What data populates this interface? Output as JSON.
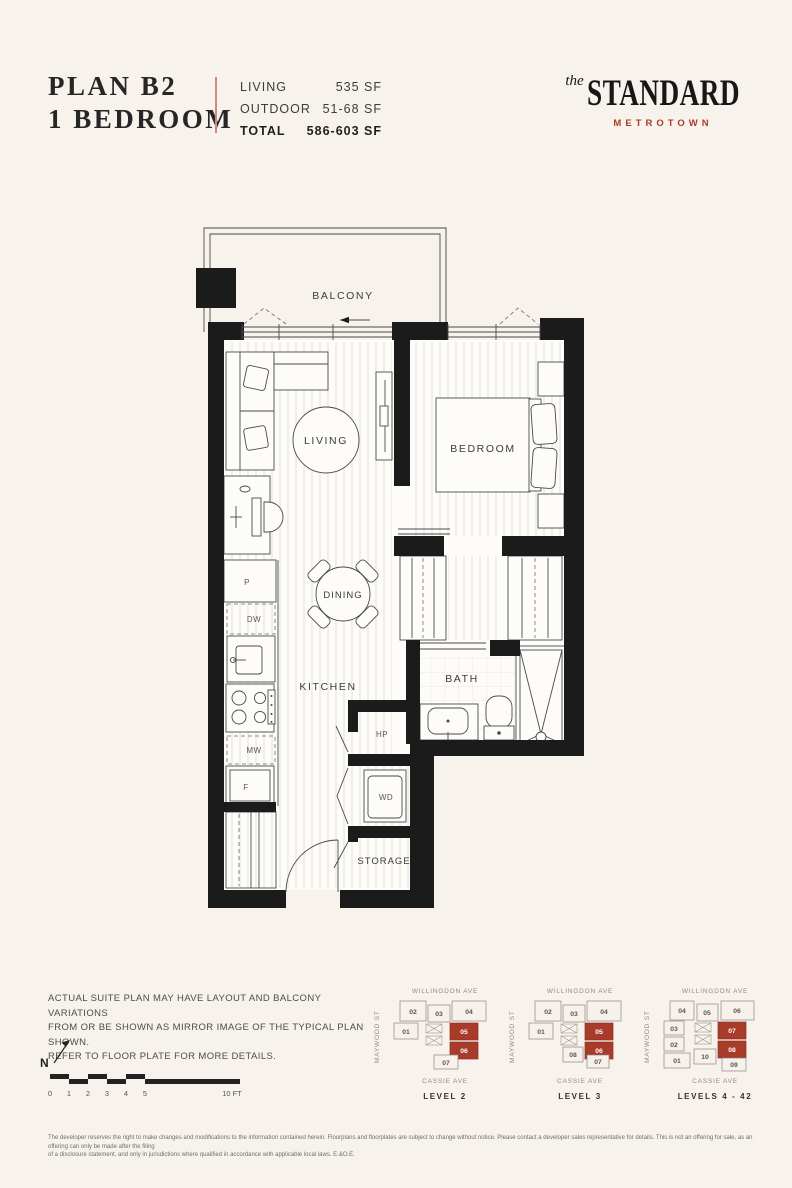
{
  "header": {
    "plan_name_line1": "PLAN B2",
    "plan_name_line2": "1 BEDROOM",
    "stats": [
      {
        "label": "LIVING",
        "value": "535 SF"
      },
      {
        "label": "OUTDOOR",
        "value": "51-68 SF"
      },
      {
        "label": "TOTAL",
        "value": "586-603 SF"
      }
    ]
  },
  "logo": {
    "prefix": "the",
    "name": "STANDARD",
    "sub": "METROTOWN",
    "accent_color": "#ad3a2a"
  },
  "floorplan": {
    "rooms": {
      "balcony": "BALCONY",
      "living": "LIVING",
      "bedroom": "BEDROOM",
      "dining": "DINING",
      "kitchen": "KITCHEN",
      "bath": "BATH",
      "storage": "STORAGE"
    },
    "appliances": {
      "pantry": "P",
      "dishwasher": "DW",
      "microwave": "MW",
      "fridge": "F",
      "heat_pump": "HP",
      "washer_dryer": "WD"
    }
  },
  "notes": {
    "line1": "ACTUAL SUITE PLAN MAY HAVE LAYOUT AND BALCONY VARIATIONS",
    "line2": "FROM OR BE SHOWN AS MIRROR IMAGE OF THE TYPICAL PLAN SHOWN.",
    "line3": "REFER TO FLOOR PLATE FOR MORE DETAILS."
  },
  "compass": {
    "label": "N"
  },
  "scale_bar": {
    "ticks": [
      "0",
      "1",
      "2",
      "3",
      "4",
      "5"
    ],
    "end_label": "10 FT"
  },
  "keyplans": [
    {
      "street_top": "WILLINGDON AVE",
      "street_left": "MAYWOOD ST",
      "street_bottom": "CASSIE AVE",
      "level_label": "LEVEL 2",
      "units": [
        {
          "label": "02",
          "highlighted": false
        },
        {
          "label": "03",
          "highlighted": false
        },
        {
          "label": "04",
          "highlighted": false
        },
        {
          "label": "01",
          "highlighted": false
        },
        {
          "label": "05",
          "highlighted": true
        },
        {
          "label": "06",
          "highlighted": true
        },
        {
          "label": "07",
          "highlighted": false
        }
      ]
    },
    {
      "street_top": "WILLINGDON AVE",
      "street_left": "MAYWOOD ST",
      "street_bottom": "CASSIE AVE",
      "level_label": "LEVEL 3",
      "units": [
        {
          "label": "02",
          "highlighted": false
        },
        {
          "label": "03",
          "highlighted": false
        },
        {
          "label": "04",
          "highlighted": false
        },
        {
          "label": "01",
          "highlighted": false
        },
        {
          "label": "05",
          "highlighted": true
        },
        {
          "label": "06",
          "highlighted": true
        },
        {
          "label": "08",
          "highlighted": false
        },
        {
          "label": "07",
          "highlighted": false
        }
      ]
    },
    {
      "street_top": "WILLINGDON AVE",
      "street_left": "MAYWOOD ST",
      "street_bottom": "CASSIE AVE",
      "level_label": "LEVELS 4 - 42",
      "units": [
        {
          "label": "04",
          "highlighted": false
        },
        {
          "label": "05",
          "highlighted": false
        },
        {
          "label": "06",
          "highlighted": false
        },
        {
          "label": "03",
          "highlighted": false
        },
        {
          "label": "02",
          "highlighted": false
        },
        {
          "label": "01",
          "highlighted": false
        },
        {
          "label": "07",
          "highlighted": true
        },
        {
          "label": "08",
          "highlighted": true
        },
        {
          "label": "10",
          "highlighted": false
        },
        {
          "label": "09",
          "highlighted": false
        }
      ]
    }
  ],
  "legal": {
    "line1": "The developer reserves the right to make changes and modifications to the information contained herein. Floorplans and floorplates are subject to change without notice. Please contact a developer sales representative for details. This is not an offering for sale, as an offering can only be made after the filing",
    "line2": "of a disclosure statement, and only in jurisdictions where qualified in accordance with applicable local laws. E.&O.E."
  }
}
